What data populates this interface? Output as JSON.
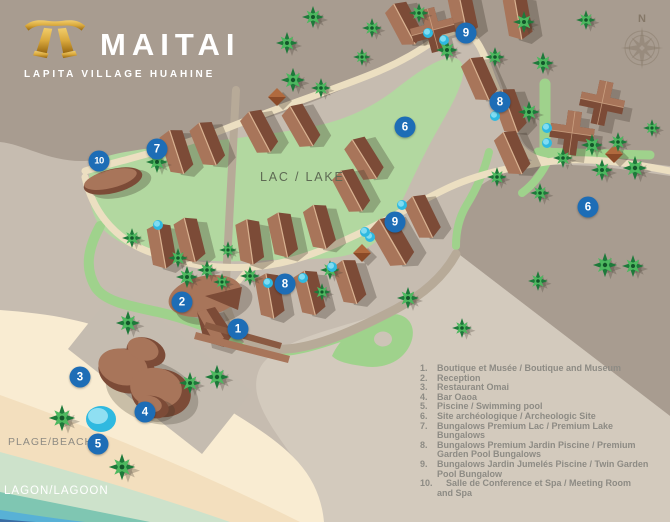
{
  "logo": {
    "title": "MAITAI",
    "subtitle": "LAPITA VILLAGE HUAHINE"
  },
  "compass": {
    "north_label": "N"
  },
  "map_labels": {
    "lake": "LAC / LAKE",
    "beach": "PLAGE/BEACH",
    "lagoon": "LAGON/LAGOON"
  },
  "markers": [
    {
      "number": "9",
      "x": 466,
      "y": 33
    },
    {
      "number": "8",
      "x": 500,
      "y": 102
    },
    {
      "number": "6",
      "x": 405,
      "y": 127
    },
    {
      "number": "6",
      "x": 588,
      "y": 207
    },
    {
      "number": "10",
      "x": 99,
      "y": 161
    },
    {
      "number": "7",
      "x": 157,
      "y": 149
    },
    {
      "number": "9",
      "x": 395,
      "y": 222
    },
    {
      "number": "8",
      "x": 285,
      "y": 284
    },
    {
      "number": "2",
      "x": 182,
      "y": 302
    },
    {
      "number": "1",
      "x": 238,
      "y": 329
    },
    {
      "number": "3",
      "x": 80,
      "y": 377
    },
    {
      "number": "4",
      "x": 145,
      "y": 412
    },
    {
      "number": "5",
      "x": 98,
      "y": 444
    }
  ],
  "legend": {
    "items": [
      {
        "number": "1.",
        "text": "Boutique et Musée / Boutique and Museum"
      },
      {
        "number": "2.",
        "text": "Reception"
      },
      {
        "number": "3.",
        "text": "Restaurant Omai"
      },
      {
        "number": "4.",
        "text": "Bar Oaoa"
      },
      {
        "number": "5.",
        "text": "Piscine / Swimming pool"
      },
      {
        "number": "6.",
        "text": "Site archéologique / Archeologic Site"
      },
      {
        "number": "7.",
        "text": "Bungalows Premium Lac / Premium Lake\nBungalows"
      },
      {
        "number": "8.",
        "text": "Bungalows Premium Jardin Piscine / Premium\nGarden Pool Bungalows"
      },
      {
        "number": "9.",
        "text": "Bungalows Jardin Jumelés Piscine / Twin Garden\nPool Bungalow"
      },
      {
        "number": "10.",
        "text": "Salle de Conference et Spa / Meeting Room\nand Spa"
      }
    ]
  },
  "colors": {
    "marker_blue": "#1d6db6",
    "lake_green": "#b2d8a0",
    "bright_green": "#9fd28c",
    "dark_ground": "#a89c90",
    "light_ground": "#c6bcb0",
    "legend_beige": "#d3cabd",
    "sand": "#f9ecd2",
    "lagoon_mint": "#cde2cb",
    "lagoon_teal": "#7fc6b2",
    "lagoon_blue": "#58b1d6",
    "lagoon_deep": "#3a6ca3",
    "building_brown_dark": "#7c4b37",
    "building_brown_light": "#a8755a",
    "palm_green": "#1d7a3a",
    "pool_cyan": "#2fb9e0",
    "logo_gold": "#d9a83c"
  }
}
